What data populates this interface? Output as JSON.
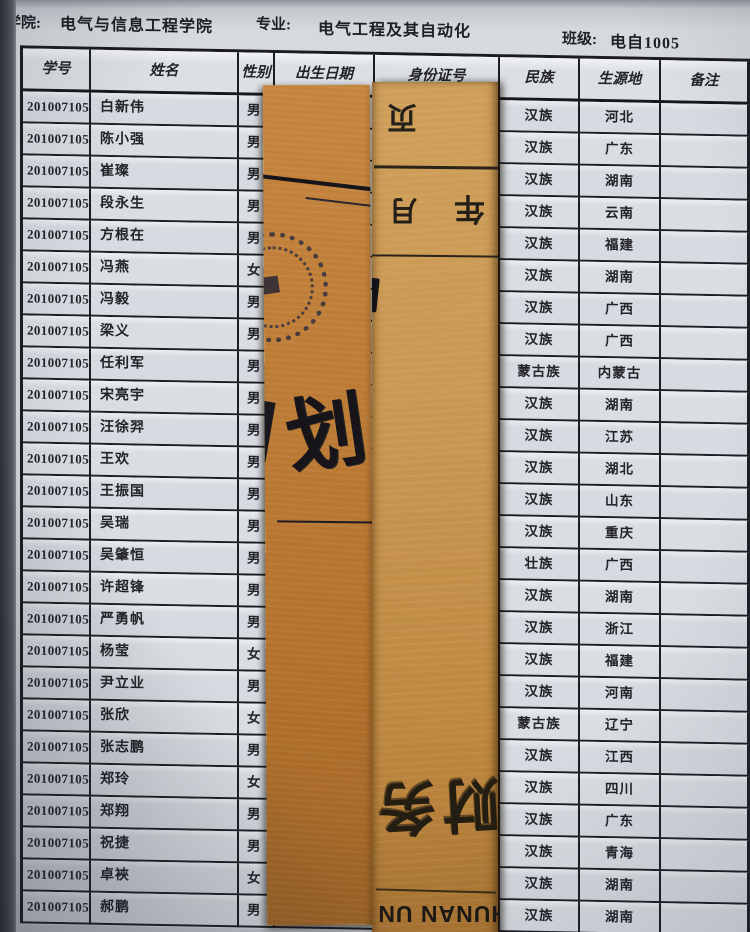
{
  "page_header": {
    "college_label": "学院:",
    "college_value": "电气与信息工程学院",
    "major_label": "专业:",
    "major_value": "电气工程及其自动化",
    "class_label": "班级:",
    "class_value": "电自1005"
  },
  "table": {
    "columns": [
      "学号",
      "姓名",
      "性别",
      "出生日期",
      "身份证号",
      "民族",
      "生源地",
      "备注"
    ],
    "rows": [
      {
        "id": "20100710501",
        "name": "白新伟",
        "gender": "男",
        "ethnicity": "汉族",
        "origin": "河北",
        "remark": ""
      },
      {
        "id": "20100710502",
        "name": "陈小强",
        "gender": "男",
        "ethnicity": "汉族",
        "origin": "广东",
        "remark": ""
      },
      {
        "id": "20100710503",
        "name": "崔璨",
        "gender": "男",
        "ethnicity": "汉族",
        "origin": "湖南",
        "remark": ""
      },
      {
        "id": "20100710504",
        "name": "段永生",
        "gender": "男",
        "ethnicity": "汉族",
        "origin": "云南",
        "remark": ""
      },
      {
        "id": "20100710505",
        "name": "方根在",
        "gender": "男",
        "ethnicity": "汉族",
        "origin": "福建",
        "remark": ""
      },
      {
        "id": "20100710506",
        "name": "冯燕",
        "gender": "女",
        "ethnicity": "汉族",
        "origin": "湖南",
        "remark": ""
      },
      {
        "id": "20100710507",
        "name": "冯毅",
        "gender": "男",
        "ethnicity": "汉族",
        "origin": "广西",
        "remark": ""
      },
      {
        "id": "20100710509",
        "name": "梁义",
        "gender": "男",
        "ethnicity": "汉族",
        "origin": "广西",
        "remark": ""
      },
      {
        "id": "20100710510",
        "name": "任利军",
        "gender": "男",
        "ethnicity": "蒙古族",
        "origin": "内蒙古",
        "remark": ""
      },
      {
        "id": "20100710511",
        "name": "宋亮宇",
        "gender": "男",
        "ethnicity": "汉族",
        "origin": "湖南",
        "remark": ""
      },
      {
        "id": "20100710512",
        "name": "汪徐羿",
        "gender": "男",
        "ethnicity": "汉族",
        "origin": "江苏",
        "remark": ""
      },
      {
        "id": "20100710513",
        "name": "王欢",
        "gender": "男",
        "ethnicity": "汉族",
        "origin": "湖北",
        "remark": ""
      },
      {
        "id": "20100710514",
        "name": "王振国",
        "gender": "男",
        "ethnicity": "汉族",
        "origin": "山东",
        "remark": ""
      },
      {
        "id": "20100710515",
        "name": "吴瑞",
        "gender": "男",
        "ethnicity": "汉族",
        "origin": "重庆",
        "remark": ""
      },
      {
        "id": "20100710516",
        "name": "吴肇恒",
        "gender": "男",
        "ethnicity": "壮族",
        "origin": "广西",
        "remark": ""
      },
      {
        "id": "20100710517",
        "name": "许超锋",
        "gender": "男",
        "ethnicity": "汉族",
        "origin": "湖南",
        "remark": ""
      },
      {
        "id": "20100710518",
        "name": "严勇帆",
        "gender": "男",
        "ethnicity": "汉族",
        "origin": "浙江",
        "remark": ""
      },
      {
        "id": "20100710519",
        "name": "杨莹",
        "gender": "女",
        "ethnicity": "汉族",
        "origin": "福建",
        "remark": ""
      },
      {
        "id": "20100710520",
        "name": "尹立业",
        "gender": "男",
        "ethnicity": "汉族",
        "origin": "河南",
        "remark": ""
      },
      {
        "id": "20100710521",
        "name": "张欣",
        "gender": "女",
        "ethnicity": "蒙古族",
        "origin": "辽宁",
        "remark": ""
      },
      {
        "id": "20100710522",
        "name": "张志鹏",
        "gender": "男",
        "ethnicity": "汉族",
        "origin": "江西",
        "remark": ""
      },
      {
        "id": "20100710523",
        "name": "郑玲",
        "gender": "女",
        "ethnicity": "汉族",
        "origin": "四川",
        "remark": ""
      },
      {
        "id": "20100710524",
        "name": "郑翔",
        "gender": "男",
        "ethnicity": "汉族",
        "origin": "广东",
        "remark": ""
      },
      {
        "id": "20100710525",
        "name": "祝捷",
        "gender": "男",
        "ethnicity": "汉族",
        "origin": "青海",
        "remark": ""
      },
      {
        "id": "20100710526",
        "name": "卓裌",
        "gender": "女",
        "ethnicity": "汉族",
        "origin": "湖南",
        "remark": ""
      },
      {
        "id": "20100710527",
        "name": "郝鹏",
        "gender": "男",
        "ethnicity": "汉族",
        "origin": "湖南",
        "remark": ""
      }
    ]
  },
  "slips": {
    "left_slip": {
      "big_char": "划"
    },
    "right_slip": {
      "page_char": "页",
      "month_char": "月",
      "year_char": "年",
      "brand_chars": "财务",
      "latin_text": "HUNAN UN"
    }
  },
  "colors": {
    "page": "#d8dcdf",
    "grid_line": "#1d1e24",
    "kraft_left": "#b2712c",
    "kraft_right": "#c99751",
    "ink": "#23242a"
  }
}
